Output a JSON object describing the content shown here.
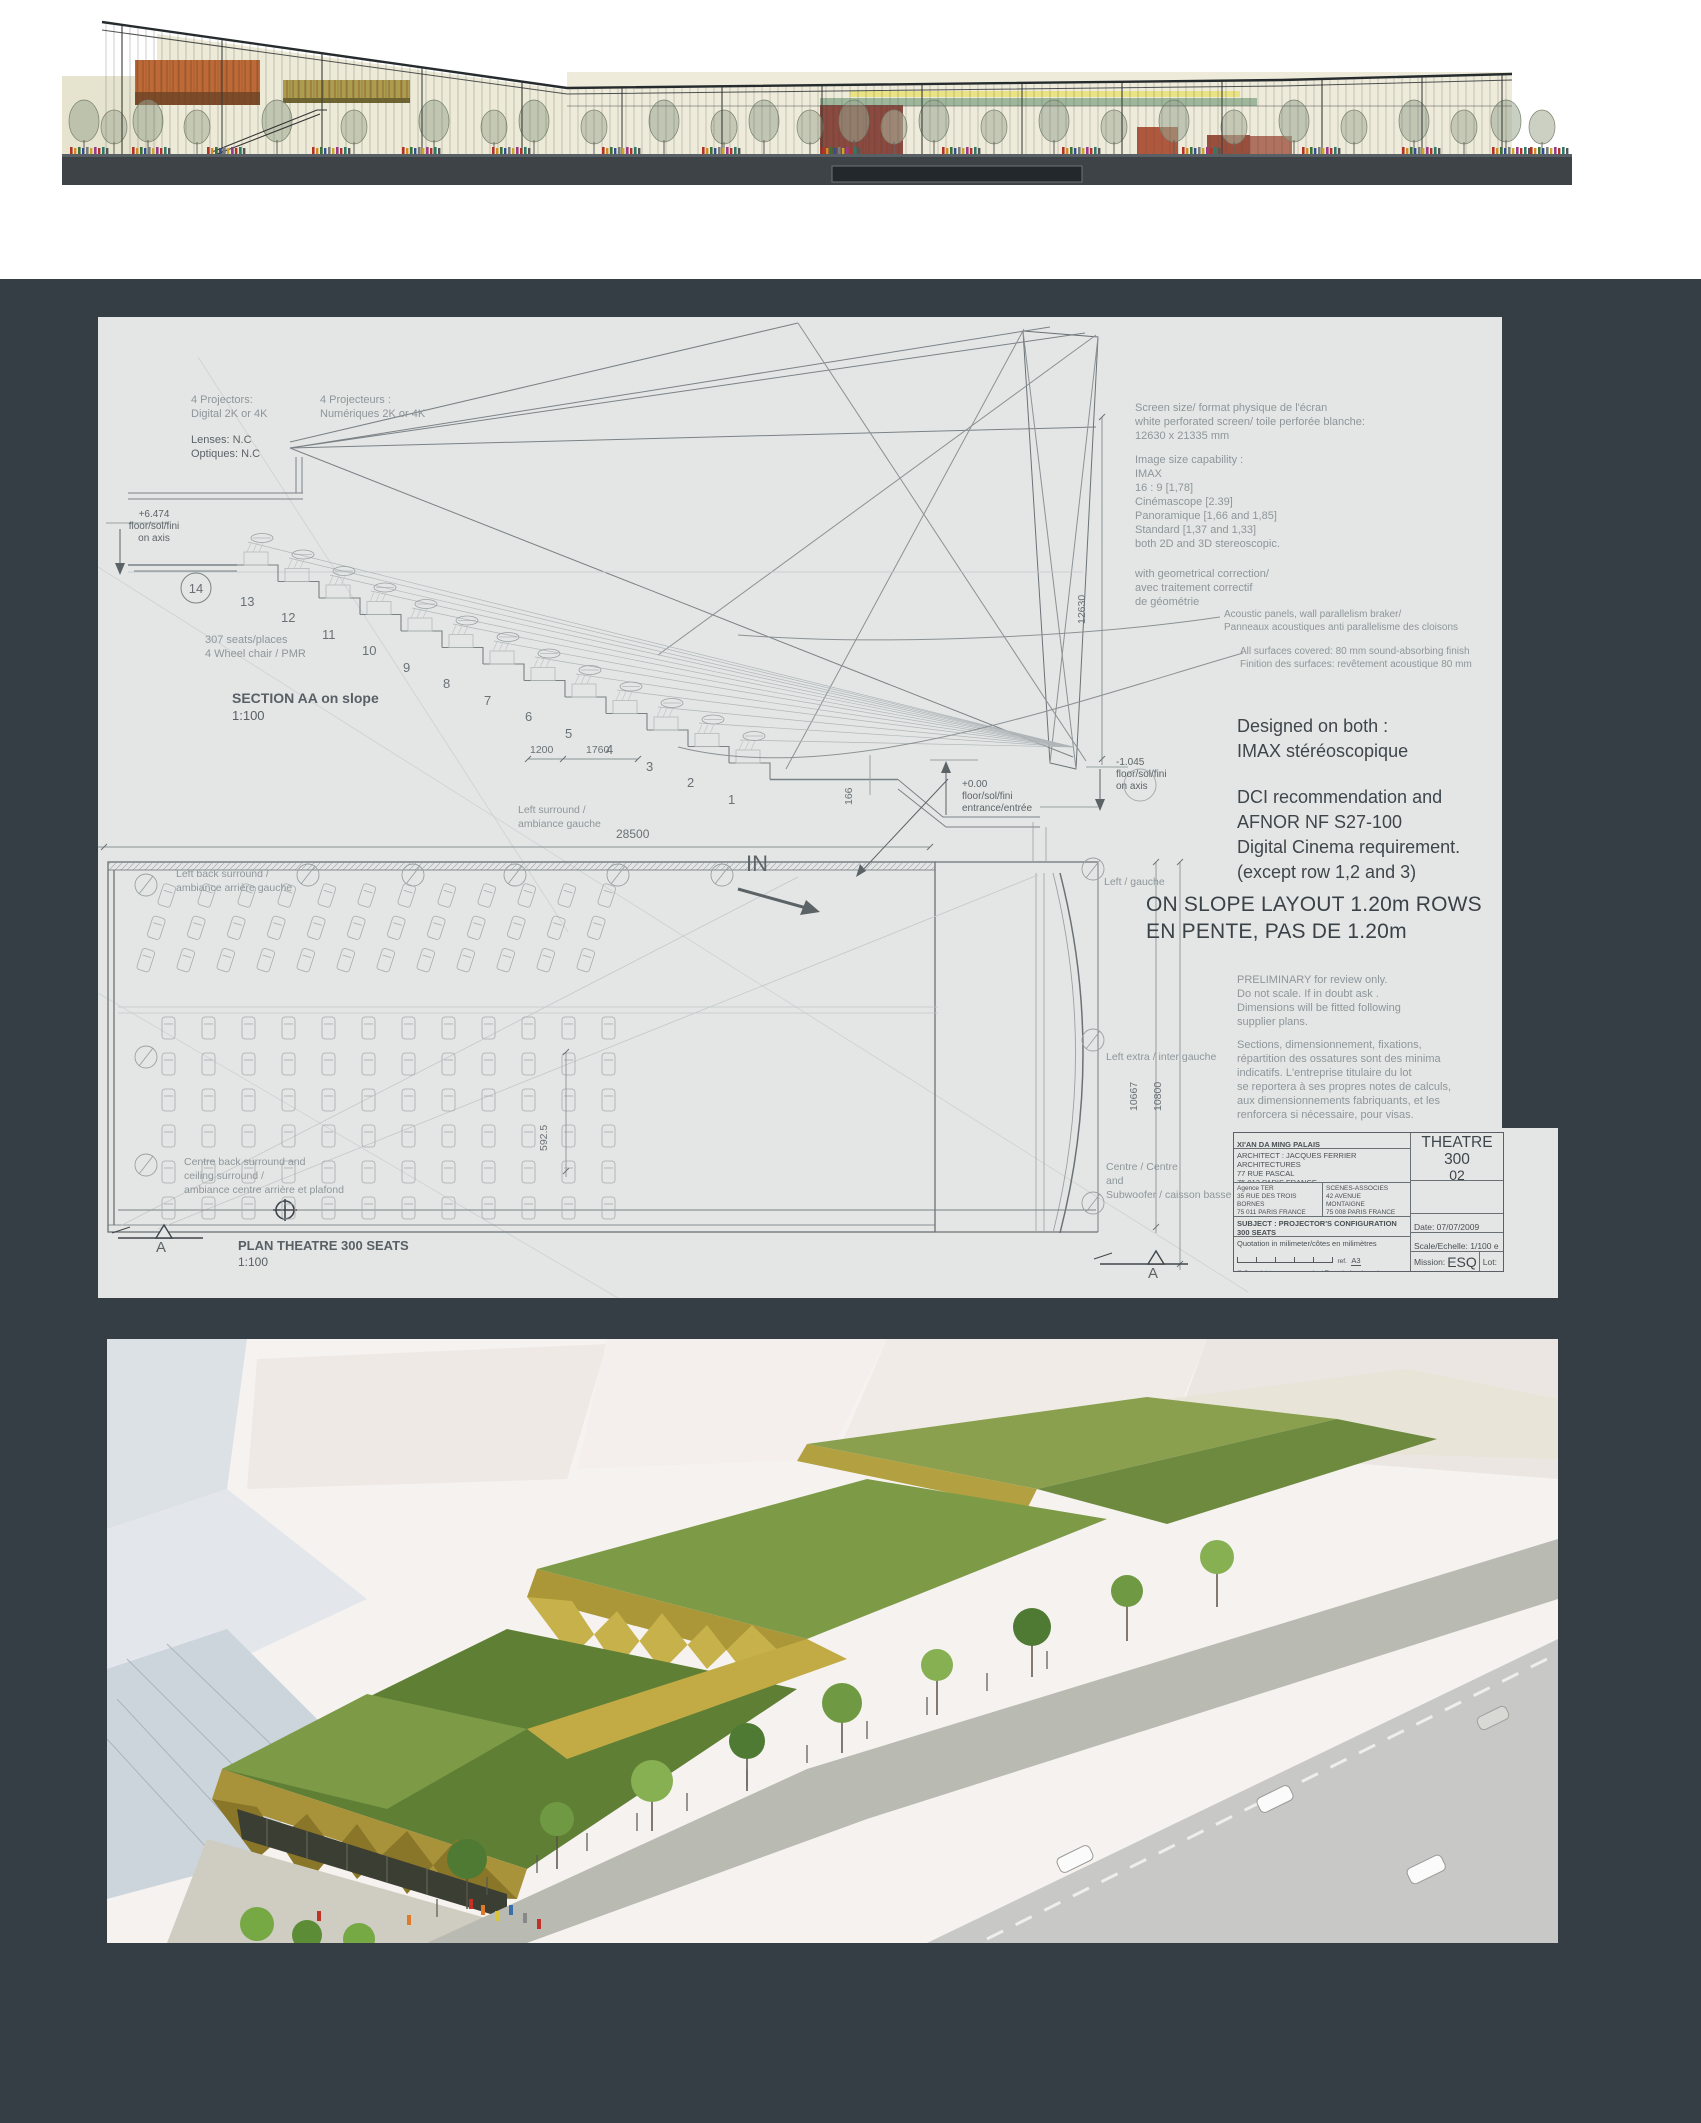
{
  "colors": {
    "panel": "#353e45",
    "sheet": "#e3e6e5",
    "roof_green": "#6d8f3f",
    "canopy_gold": "#b39c3b",
    "elevation_orange": "#bf6a36",
    "elevation_olive": "#ac9c4e"
  },
  "sheet": {
    "section": {
      "projectors_en": "4 Projectors:\nDigital 2K or 4K",
      "projectors_fr": "4 Projecteurs :\nNumériques 2K or 4K",
      "lenses": "Lenses: N.C\nOptiques: N.C",
      "level_top": "+6.474\nfloor/sol/fini\non axis",
      "row_circle": "14",
      "row_numbers": [
        "13",
        "12",
        "11",
        "10",
        "9",
        "8",
        "7",
        "6",
        "5",
        "4",
        "3",
        "2",
        "1"
      ],
      "seats_note": "307 seats/places\n4 Wheel chair / PMR",
      "title": "SECTION AA on slope",
      "scale": "1:100",
      "dim_1200": "1200",
      "dim_1760": "1760",
      "dim_166": "166",
      "dim_12630": "12630",
      "dim_28500": "28500",
      "level_entrance": "+0.00\nfloor/sol/fini\nentrance/entrée",
      "level_screen": "-1.045\nfloor/sol/fini\non axis",
      "left_surround": "Left surround /\nambiance gauche"
    },
    "plan": {
      "left_back_surround": "Left back surround /\nambiance arrière gauche",
      "in_label": "IN",
      "left_gauche": "Left / gauche",
      "left_extra": "Left extra / inter gauche",
      "centre_subwoofer": "Centre / Centre\nand\nSubwoofer / caisson basse",
      "centre_back": "Centre back surround and\nceiling surround /\nambiance centre arrière et plafond",
      "dim_10667": "10667",
      "dim_10800": "10800",
      "dim_592": "592.5",
      "title": "PLAN THEATRE 300 SEATS",
      "scale": "1:100",
      "marker_a_left": "A",
      "marker_a_right": "A"
    },
    "notes": {
      "screen_size": "Screen size/ format physique de l'écran\nwhite perforated screen/ toile perforée blanche:\n12630 x 21335 mm",
      "image_size": "Image size capability :\nIMAX\n16 : 9 [1,78]\nCinémascope [2.39]\nPanoramique [1,66 and 1,85]\nStandard [1,37 and 1,33]\nboth 2D and 3D stereoscopic.",
      "geometry": "with geometrical correction/\navec traitement correctif\nde géométrie",
      "acoustic": "Acoustic panels, wall parallelism braker/\nPanneaux acoustiques anti parallelisme des cloisons",
      "surfaces": "All surfaces covered: 80 mm sound-absorbing finish\nFinition des surfaces: revêtement acoustique 80 mm",
      "designed": "Designed on both :\nIMAX stéréoscopique",
      "dci": "DCI recommendation and\nAFNOR NF S27-100\nDigital Cinema requirement.\n(except row 1,2 and 3)",
      "slope": "ON SLOPE LAYOUT 1.20m ROWS\nEN PENTE, PAS DE 1.20m",
      "preliminary": "PRELIMINARY for review only.\nDo not scale. If in doubt ask .\nDimensions will be fitted following\nsupplier plans.",
      "sections_note": "Sections, dimensionnement, fixations,\nrépartition des ossatures sont des minima\nindicatifs. L'entreprise titulaire du lot\nse reportera à ses propres notes de calculs,\naux dimensionnements fabriquants, et les\nrenforcera si nécessaire, pour visas."
    },
    "titleblock": {
      "project": "XI'AN DA MING PALAIS",
      "project2": "TOURIST COMPLEX",
      "architect": "ARCHITECT : JACQUES FERRIER ARCHITECTURES\n77 RUE PASCAL\n75 013 PARIS FRANCE",
      "tel": "Tel: +33 (0)1 43 13 20 20   Fax: +33 (0)1 43 13 20 21",
      "agence": "Agence TER\n35 RUE DES TROIS BORNES\n75 011 PARIS FRANCE\nwww.agenceter.com",
      "scenes": "SCENES-ASSOCIES\n42 AVENUE MONTAIGNE\n75 008 PARIS FRANCE\nwww.scenes-associes.com",
      "logo_glyph": "✳",
      "subject": "SUBJECT : PROJECTOR'S CONFIGURATION 300 SEATS\nSUJET : PRINCIPE PROJECTIONS 300 PLACES",
      "quotation": "Quotation in milimeter/côtes en milimètres",
      "ref": "ref.",
      "paper": "A3",
      "copyright": "© Copyright scenes-associes/ Tous droits réservés pour tous pays.",
      "doc_title": "THEATRE 300",
      "doc_number": "02",
      "no_label": "NO.",
      "date": "Date: 07/07/2009",
      "scale": "Scale/Echelle: 1/100 e",
      "mission_label": "Mission:",
      "mission": "ESQ",
      "lot": "Lot:"
    }
  }
}
